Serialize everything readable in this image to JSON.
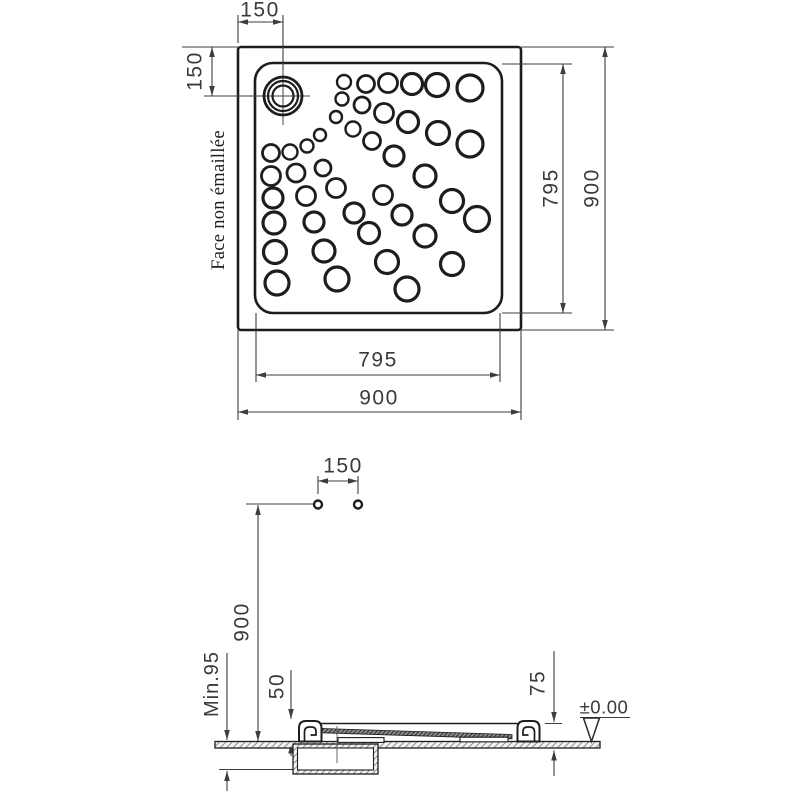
{
  "top_view": {
    "face_label": "Face non émaillée",
    "dims": {
      "drain_offset_top": "150",
      "drain_offset_left": "150",
      "inner_height": "795",
      "outer_height": "900",
      "inner_width": "795",
      "outer_width": "900"
    },
    "drain": {
      "cx": 283,
      "cy": 96,
      "radii": [
        19,
        15,
        10.5
      ]
    },
    "bumps": [
      [
        344,
        82,
        7
      ],
      [
        366,
        84,
        8.5
      ],
      [
        388,
        83,
        9.5
      ],
      [
        412,
        84,
        10.5
      ],
      [
        437,
        85,
        11.5
      ],
      [
        470,
        88,
        13
      ],
      [
        342,
        99,
        6.5
      ],
      [
        362,
        105,
        8
      ],
      [
        384,
        113,
        9.5
      ],
      [
        408,
        122,
        10.5
      ],
      [
        438,
        133,
        11.5
      ],
      [
        470,
        144,
        13
      ],
      [
        336,
        117,
        6
      ],
      [
        353,
        129,
        7.5
      ],
      [
        372,
        141,
        8.5
      ],
      [
        394,
        156,
        10
      ],
      [
        425,
        176,
        11
      ],
      [
        452,
        201,
        11.5
      ],
      [
        477,
        219,
        12.5
      ],
      [
        336,
        188,
        9.5
      ],
      [
        354,
        213,
        10
      ],
      [
        369,
        233,
        10.5
      ],
      [
        387,
        262,
        11.5
      ],
      [
        407,
        289,
        12
      ],
      [
        383,
        195,
        9.5
      ],
      [
        402,
        215,
        10
      ],
      [
        425,
        236,
        11
      ],
      [
        452,
        264,
        11.5
      ],
      [
        320,
        135,
        6
      ],
      [
        307,
        146,
        6.5
      ],
      [
        290,
        152,
        7.5
      ],
      [
        271,
        153,
        8.5
      ],
      [
        323,
        168,
        8
      ],
      [
        296,
        173,
        9
      ],
      [
        271,
        176,
        9.5
      ],
      [
        273,
        198,
        10
      ],
      [
        274,
        223,
        11
      ],
      [
        275,
        252,
        11.5
      ],
      [
        277,
        283,
        12
      ],
      [
        306,
        196,
        9.5
      ],
      [
        314,
        222,
        10
      ],
      [
        324,
        251,
        11
      ],
      [
        337,
        279,
        12
      ]
    ]
  },
  "section_view": {
    "dims": {
      "screw_spacing": "150",
      "height": "900",
      "recess_depth": "Min.95",
      "rim_height": "50",
      "edge_height": "75",
      "floor_datum": "±0.00"
    },
    "screw_markers": [
      [
        318,
        504.5
      ],
      [
        358,
        504.5
      ]
    ]
  },
  "colors": {
    "line": "#1d1d1d",
    "dim": "#3a3a3a",
    "background": "#ffffff"
  }
}
